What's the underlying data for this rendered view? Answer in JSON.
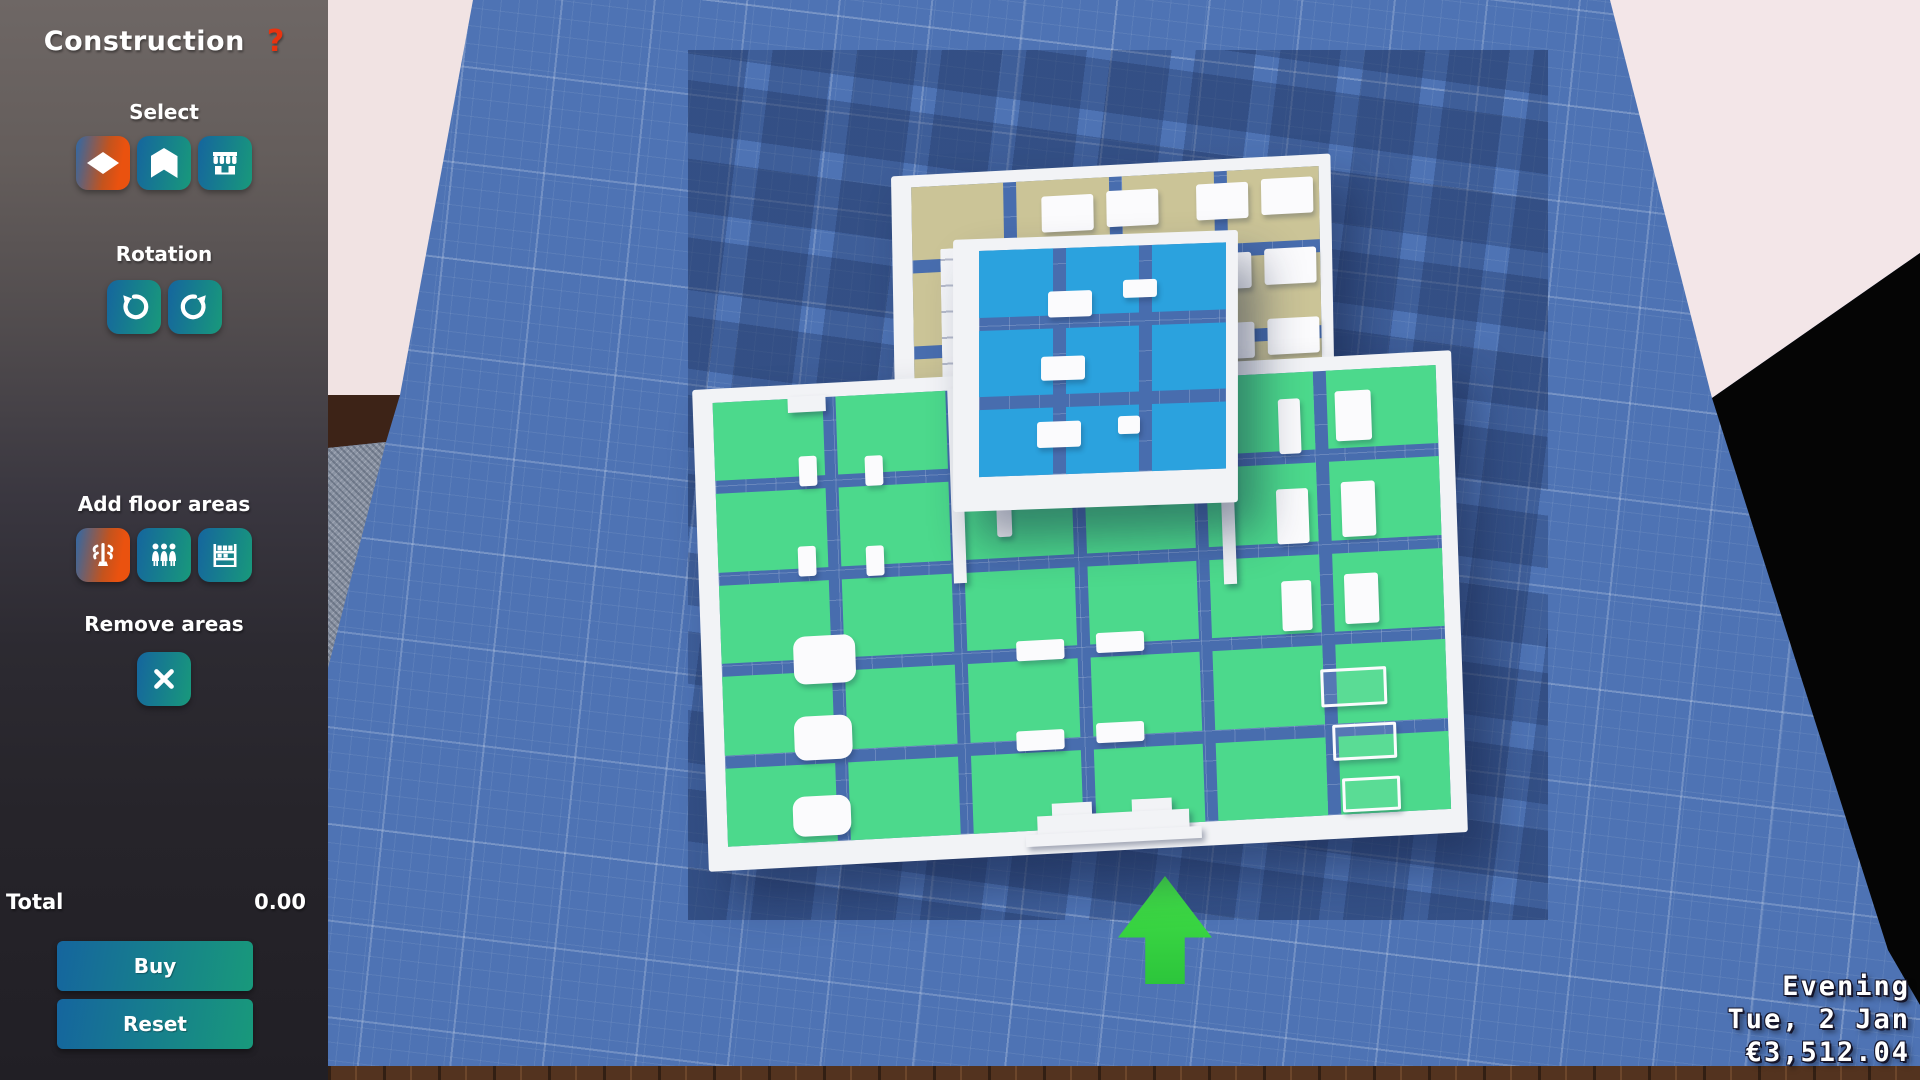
{
  "panel": {
    "title": "Construction",
    "help_label": "?",
    "select": {
      "label": "Select",
      "buttons": [
        {
          "icon": "diamond-icon",
          "selected": true
        },
        {
          "icon": "walls-icon",
          "selected": false
        },
        {
          "icon": "storefront-icon",
          "selected": false
        }
      ]
    },
    "rotation": {
      "label": "Rotation",
      "buttons": [
        {
          "icon": "rotate-ccw-icon"
        },
        {
          "icon": "rotate-cw-icon"
        }
      ]
    },
    "add_floor_areas": {
      "label": "Add floor areas",
      "buttons": [
        {
          "icon": "coat-rack-icon",
          "selected": true
        },
        {
          "icon": "people-icon",
          "selected": false
        },
        {
          "icon": "shelf-rack-icon",
          "selected": false
        }
      ]
    },
    "remove_areas": {
      "label": "Remove areas",
      "buttons": [
        {
          "icon": "x-icon"
        }
      ]
    },
    "total_label": "Total",
    "total_value": "0.00",
    "buy_label": "Buy",
    "reset_label": "Reset"
  },
  "hud": {
    "time_of_day": "Evening",
    "date": "Tue, 2 Jan",
    "money": "€3,512.04"
  },
  "colors": {
    "accent_blue": "#15659e",
    "accent_teal": "#18997b",
    "selected_orange": "#ea520f",
    "help_red": "#e8330f",
    "ground_blue": "#4e73b4",
    "floor_green": "#4cd98c",
    "floor_blue": "#2ba2de",
    "floor_tan": "#cbc497",
    "arrow_green": "#3bdc3f"
  },
  "scene": {
    "rooms": [
      {
        "id": "blue-room",
        "floor_color": "#2ba2de",
        "cols": 3,
        "rows": 3
      },
      {
        "id": "tan-room",
        "floor_color": "#cbc497",
        "cols": 4,
        "rows": 3
      },
      {
        "id": "green-room",
        "floor_color": "#4cd98c",
        "cols": 6,
        "rows": 5
      }
    ]
  }
}
